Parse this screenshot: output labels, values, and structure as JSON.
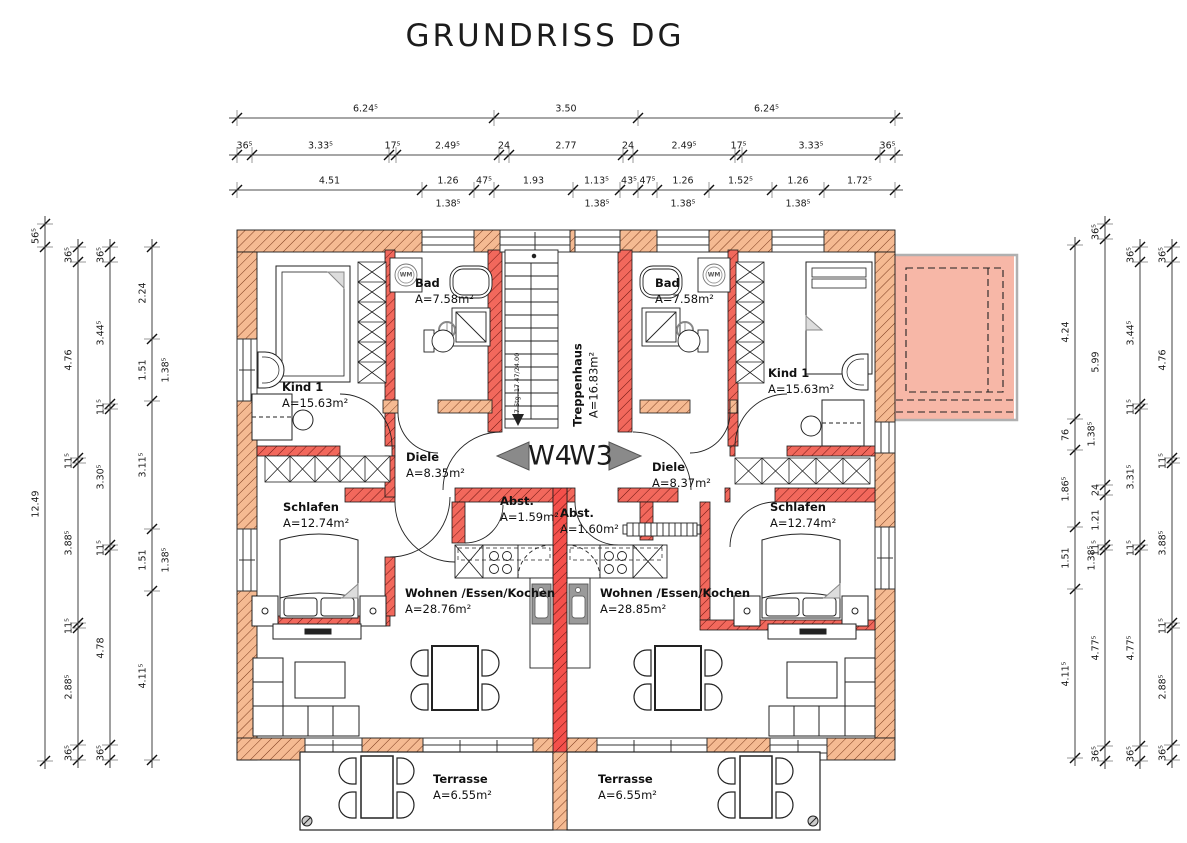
{
  "title": "GRUNDRISS DG",
  "apartments": {
    "left": "W4",
    "right": "W3"
  },
  "rooms": {
    "kind1_left": {
      "name": "Kind 1",
      "area": "A=15.63m²"
    },
    "bad_left": {
      "name": "Bad",
      "area": "A=7.58m²"
    },
    "treppenhaus": {
      "name": "Treppenhaus",
      "area": "A=16.83m²"
    },
    "bad_right": {
      "name": "Bad",
      "area": "A=7.58m²"
    },
    "kind1_right": {
      "name": "Kind 1",
      "area": "A=15.63m²"
    },
    "diele_left": {
      "name": "Diele",
      "area": "A=8.35m²"
    },
    "diele_right": {
      "name": "Diele",
      "area": "A=8.37m²"
    },
    "abst_left": {
      "name": "Abst.",
      "area": "A=1.59m²"
    },
    "abst_right": {
      "name": "Abst.",
      "area": "A=1.60m²"
    },
    "schlafen_left": {
      "name": "Schlafen",
      "area": "A=12.74m²"
    },
    "schlafen_right": {
      "name": "Schlafen",
      "area": "A=12.74m²"
    },
    "wohnen_left": {
      "name": "Wohnen /Essen/Kochen",
      "area": "A=28.76m²"
    },
    "wohnen_right": {
      "name": "Wohnen /Essen/Kochen",
      "area": "A=28.85m²"
    },
    "terrasse_left": {
      "name": "Terrasse",
      "area": "A=6.55m²"
    },
    "terrasse_right": {
      "name": "Terrasse",
      "area": "A=6.55m²"
    }
  },
  "stair_note": "17 Stg. 17.47/24.00",
  "fixtures": {
    "washing_machine": "WM"
  },
  "dimensions": {
    "top": {
      "row1": [
        "6.24⁵",
        "3.50",
        "6.24⁵"
      ],
      "row2": [
        "36⁵",
        "3.33⁵",
        "17⁵",
        "2.49⁵",
        "24",
        "2.77",
        "24",
        "2.49⁵",
        "17⁵",
        "3.33⁵",
        "36⁵"
      ],
      "row3": [
        "4.51",
        "1.26",
        "47⁵",
        "1.93",
        "1.13⁵",
        "43⁵",
        "47⁵",
        "1.26",
        "1.52⁵",
        "1.26",
        "1.72⁵"
      ],
      "sills": [
        "1.38⁵",
        "1.38⁵",
        "1.38⁵",
        "1.38⁵"
      ]
    },
    "left": {
      "col1": [
        "56⁵",
        "12.49"
      ],
      "col2": [
        "36⁵",
        "4.76",
        "11⁵",
        "3.88⁵",
        "11⁵",
        "2.88⁵",
        "36⁵"
      ],
      "col3": [
        "36⁵",
        "3.44⁵",
        "11⁵",
        "3.30⁵",
        "11⁵",
        "4.78",
        "36⁵"
      ],
      "col4": [
        "2.24",
        "1.51",
        "3.11⁵",
        "1.51",
        "4.11⁵"
      ],
      "col4_sills": [
        "1.38⁵",
        "1.38⁵"
      ]
    },
    "right": {
      "col1": [
        "4.24",
        "76",
        "1.86⁵",
        "1.51",
        "4.11⁵"
      ],
      "col1_sills": [
        "1.38⁵",
        "1.38⁵"
      ],
      "col2": [
        "36⁵",
        "5.99",
        "24",
        "1.21",
        "11⁵",
        "4.77⁵",
        "36⁵"
      ],
      "col3": [
        "36⁵",
        "3.44⁵",
        "11⁵",
        "3.31⁵",
        "11⁵",
        "4.77⁵",
        "36⁵"
      ],
      "col4": [
        "36⁵",
        "4.76",
        "11⁵",
        "3.88⁵",
        "11⁵",
        "2.88⁵",
        "36⁵"
      ]
    }
  },
  "colors": {
    "wall_exterior": "#f5ba92",
    "wall_interior": "#f2685c",
    "wall_party": "#f4504b",
    "roof_terrace_fill": "#f7b7a7",
    "furniture_gray": "#9a9a9a",
    "arrow_gray": "#8a8a8a"
  }
}
